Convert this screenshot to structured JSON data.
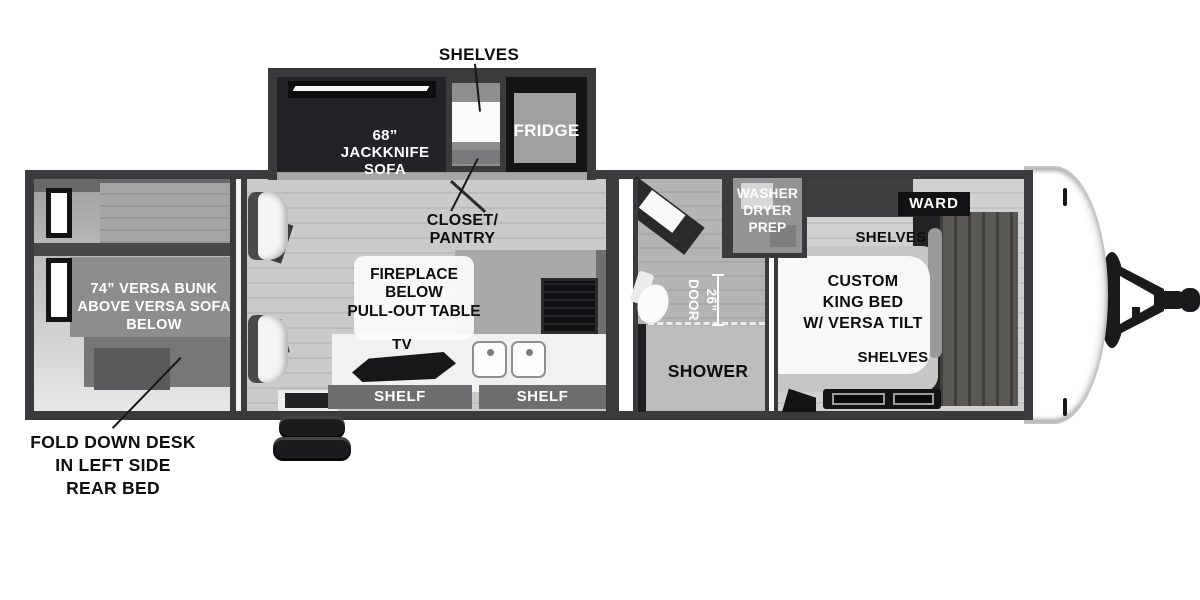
{
  "palette": {
    "wall": "#3b3b3d",
    "floor_light": "#cfcfcf",
    "floor_mid": "#b2b2b2",
    "furniture_black": "#161618",
    "banner_gray": "#6e6e70",
    "label_dark": "#0e0e0e",
    "label_light": "#ffffff",
    "background": "#ffffff"
  },
  "slideout": {
    "shelves_callout": "SHELVES",
    "sofa": "68”\nJACKKNIFE\nSOFA",
    "fridge": "FRIDGE",
    "closet_pantry": "CLOSET/\nPANTRY"
  },
  "rear_bedroom": {
    "bunk": "74” VERSA BUNK\nABOVE VERSA SOFA\nBELOW",
    "fold_down_desk": "FOLD DOWN DESK\nIN LEFT SIDE\nREAR BED"
  },
  "living": {
    "fireplace_table": "FIREPLACE\nBELOW\nPULL-OUT TABLE",
    "tv": "TV",
    "shelf_left": "SHELF",
    "shelf_right": "SHELF"
  },
  "bathroom": {
    "door_width": "26”\nDOOR",
    "shower": "SHOWER",
    "washer_dryer_prep": "WASHER\nDRYER\nPREP"
  },
  "front_bedroom": {
    "ward": "WARD",
    "shelves_top": "SHELVES",
    "king_bed": "CUSTOM\nKING BED\nW/ VERSA TILT",
    "shelves_bottom": "SHELVES"
  }
}
